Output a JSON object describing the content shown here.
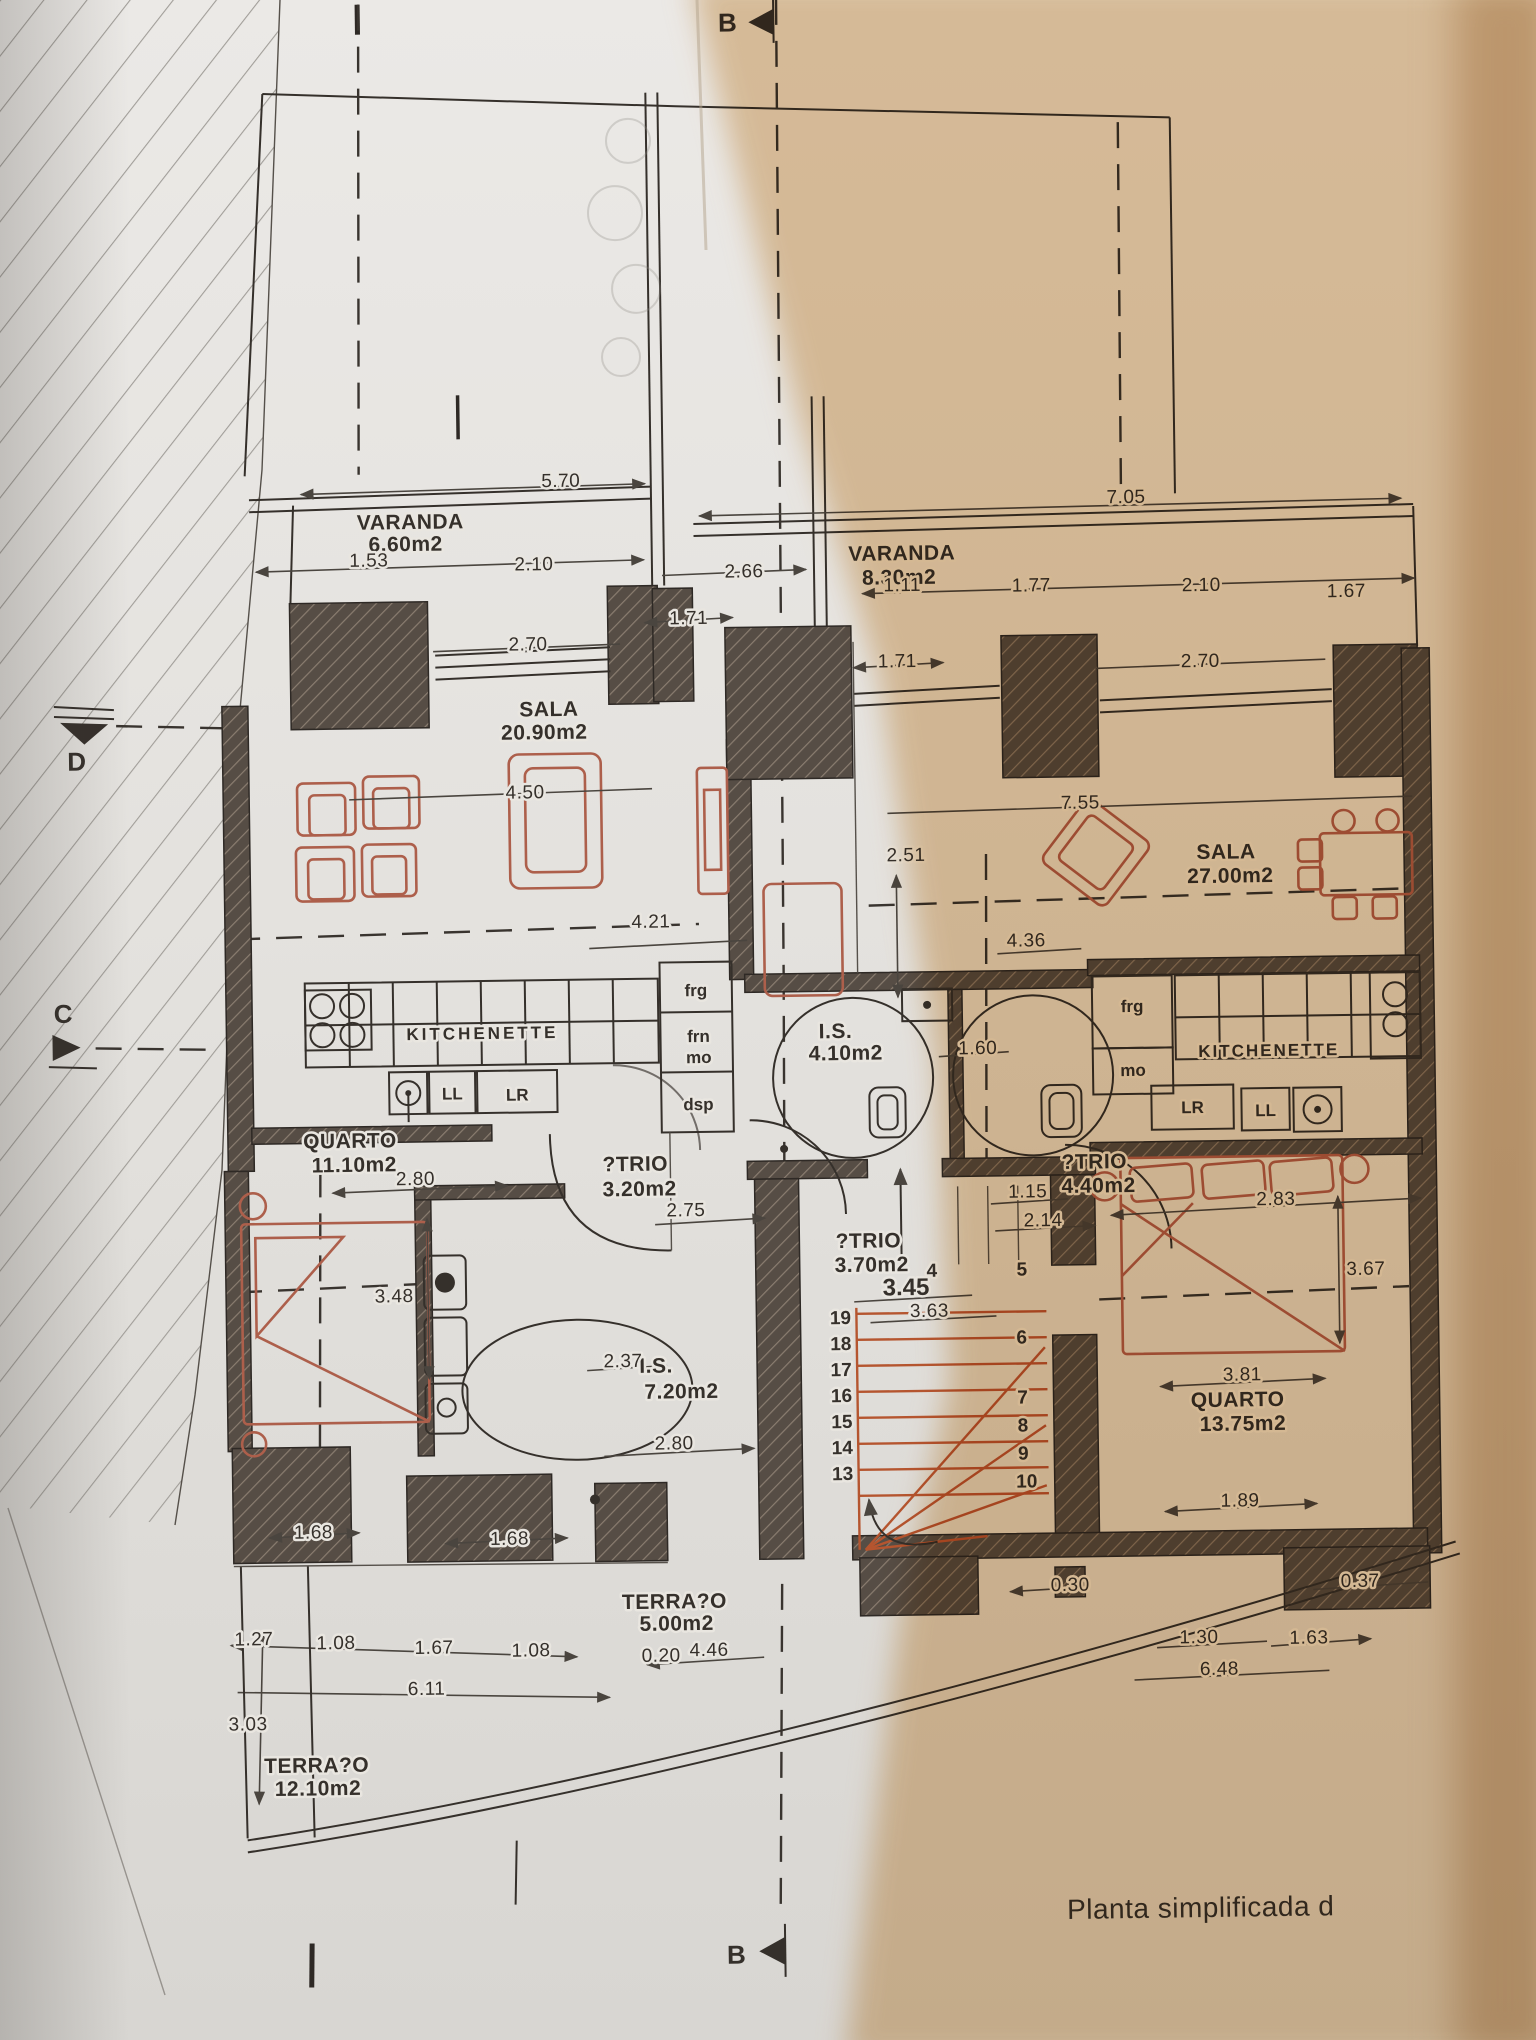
{
  "title": "Planta simplificada (floor plan photo)",
  "caption": "Planta simplificada d",
  "markers": {
    "b": "B",
    "c": "C",
    "d": "D"
  },
  "rooms": {
    "varanda_l": {
      "name": "VARANDA",
      "area": "6.60m2"
    },
    "varanda_r": {
      "name": "VARANDA",
      "area": "8.30m2"
    },
    "sala_l": {
      "name": "SALA",
      "area": "20.90m2"
    },
    "sala_r": {
      "name": "SALA",
      "area": "27.00m2"
    },
    "quarto_l": {
      "name": "QUARTO",
      "area": "11.10m2"
    },
    "quarto_r": {
      "name": "QUARTO",
      "area": "13.75m2"
    },
    "atrio_l": {
      "name": "?TRIO",
      "area": "3.20m2"
    },
    "atrio_m": {
      "name": "?TRIO",
      "area": "3.70m2"
    },
    "atrio_r": {
      "name": "?TRIO",
      "area": "4.40m2"
    },
    "is_l": {
      "name": "I.S.",
      "area": "7.20m2"
    },
    "is_m": {
      "name": "I.S.",
      "area": "4.10m2"
    },
    "terraco_l": {
      "name": "TERRA?O",
      "area": "12.10m2"
    },
    "terraco_m": {
      "name": "TERRA?O",
      "area": "5.00m2"
    },
    "kitch_l": {
      "name": "KITCHENETTE"
    },
    "kitch_r": {
      "name": "KITCHENETTE"
    }
  },
  "kitchen": {
    "frg": "frg",
    "frn": "frn",
    "mo": "mo",
    "dsp": "dsp",
    "ll": "LL",
    "lr": "LR"
  },
  "stairs": {
    "flight_a": [
      "19",
      "18",
      "17",
      "16",
      "15",
      "14",
      "13"
    ],
    "flight_b": [
      "4",
      "5",
      "6",
      "7",
      "8",
      "9",
      "10"
    ]
  },
  "dims": {
    "w570": "5.70",
    "w153": "1.53",
    "w210a": "2.10",
    "w266": "2.66",
    "w270a": "2.70",
    "w450": "4.50",
    "w421": "4.21",
    "w280a": "2.80",
    "w275": "2.75",
    "w348": "3.48",
    "w237": "2.37",
    "w280b": "2.80",
    "w168a": "1.68",
    "w168b": "1.68",
    "w127": "1.27",
    "w108a": "1.08",
    "w167a": "1.67",
    "w108b": "1.08",
    "w611": "6.11",
    "w303": "3.03",
    "w705": "7.05",
    "w111": "1.11",
    "w177": "1.77",
    "w210b": "2.10",
    "w167b": "1.67",
    "w171a": "1.71",
    "w171b": "1.71",
    "w270b": "2.70",
    "w755": "7.55",
    "w251": "2.51",
    "w436": "4.36",
    "w160": "1.60",
    "w345": "3.45",
    "w363": "3.63",
    "w115": "1.15",
    "w214": "2.14",
    "w283": "2.83",
    "w367": "3.67",
    "w381": "3.81",
    "w189": "1.89",
    "w030": "0.30",
    "w037": "0.37",
    "w020": "0.20",
    "w446": "4.46",
    "w130": "1.30",
    "w163": "1.63",
    "w648": "6.48"
  },
  "colors": {
    "paper": "#e7e5e1",
    "warm": "#e6c79f",
    "ink": "#35302b",
    "wallfill": "#554c44",
    "furniture": "#ad5f4b",
    "tread": "#b5552f"
  }
}
